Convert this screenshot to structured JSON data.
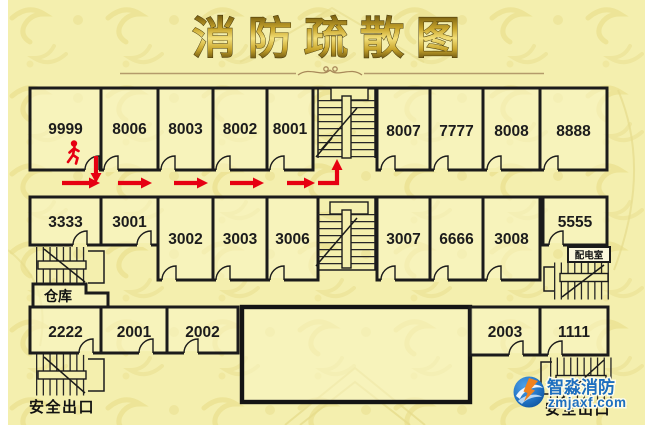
{
  "title": "消防疏散图",
  "plan": {
    "rooms": {
      "top_left": [
        "9999",
        "8006",
        "8003",
        "8002",
        "8001"
      ],
      "top_right": [
        "8007",
        "7777",
        "8008",
        "8888"
      ],
      "mid_upper_left": [
        "3333",
        "3001"
      ],
      "mid_lower_left": [
        "3002",
        "3003",
        "3006"
      ],
      "mid_right": [
        "3007",
        "6666",
        "3008"
      ],
      "mid_upper_right": "5555",
      "bottom_left": [
        "2222",
        "2001",
        "2002"
      ],
      "bottom_right": [
        "2003",
        "1111"
      ]
    },
    "labels": {
      "warehouse": "仓库",
      "power_room": "配电室",
      "exit_left": "安全出口",
      "exit_right": "安全出口"
    }
  },
  "logo": {
    "brand": "智淼消防",
    "site": "zmjaxf.com"
  },
  "colors": {
    "board_background": "#f4efae",
    "wall": "#1b1b1b",
    "evacuation_route": "#e60012",
    "title_gold": "#caa62c",
    "logo_blue": "#1d6fc0",
    "logo_orange": "#f0821e"
  }
}
